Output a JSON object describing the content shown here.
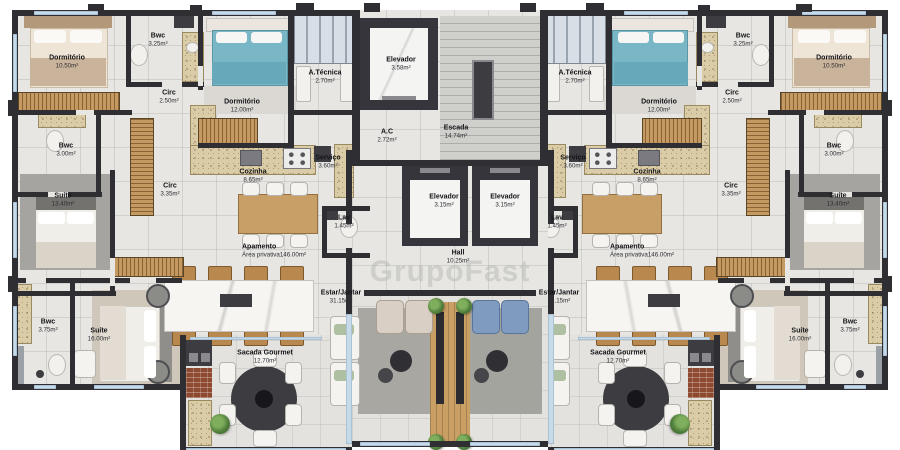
{
  "watermark": "GrupoFast",
  "colors": {
    "wall": "#2e2e33",
    "floor": "#e7e6e3",
    "wood": "#c8a067",
    "teal_bed": "#79b6c6",
    "blue_chair": "#7f9cc0",
    "beige_chair": "#d9cfc4",
    "brick": "#8d4a30",
    "window": "#c6dae9"
  },
  "rooms": [
    {
      "label": "Dormitório",
      "area": "10.50m²"
    },
    {
      "label": "Bwc",
      "area": "3.25m²"
    },
    {
      "label": "Circ",
      "area": "2.50m²"
    },
    {
      "label": "Dormitório",
      "area": "12.00m²"
    },
    {
      "label": "Bwc",
      "area": "3.00m²"
    },
    {
      "label": "Circ",
      "area": "3.35m²"
    },
    {
      "label": "Suíte",
      "area": "13.40m²"
    },
    {
      "label": "A.Técnica",
      "area": "2.70m²"
    },
    {
      "label": "Cozinha",
      "area": "8.65m²"
    },
    {
      "label": "Serviço",
      "area": "3.60m²"
    },
    {
      "label": "Lav",
      "area": "1.45m²"
    },
    {
      "label": "Apamento",
      "area": "Área privativa146.00m²"
    },
    {
      "label": "Bwc",
      "area": "3.75m²"
    },
    {
      "label": "Suíte",
      "area": "16.00m²"
    },
    {
      "label": "Estar/Jantar",
      "area": "31.15m²"
    },
    {
      "label": "Sacada Gourmet",
      "area": "12.70m²"
    },
    {
      "label": "Elevador",
      "area": "3.58m²"
    },
    {
      "label": "A.C",
      "area": "2.72m²"
    },
    {
      "label": "Escada",
      "area": "14.74m²"
    },
    {
      "label": "Elevador",
      "area": "3.15m²"
    },
    {
      "label": "Elevador",
      "area": "3.15m²"
    },
    {
      "label": "Hall",
      "area": "10.25m²"
    },
    {
      "label": "A.Técnica",
      "area": "2.70m²"
    },
    {
      "label": "Dormitório",
      "area": "12.00m²"
    },
    {
      "label": "Bwc",
      "area": "3.25m²"
    },
    {
      "label": "Dormitório",
      "area": "10.50m²"
    },
    {
      "label": "Circ",
      "area": "2.50m²"
    },
    {
      "label": "Serviço",
      "area": "3.60m²"
    },
    {
      "label": "Cozinha",
      "area": "8.65m²"
    },
    {
      "label": "Lav",
      "area": "1.45m²"
    },
    {
      "label": "Bwc",
      "area": "3.00m²"
    },
    {
      "label": "Circ",
      "area": "3.35m²"
    },
    {
      "label": "Suíte",
      "area": "13.40m²"
    },
    {
      "label": "Apamento",
      "area": "Área privativa146.00m²"
    },
    {
      "label": "Estar/Jantar",
      "area": "31.15m²"
    },
    {
      "label": "Sacada Gourmet",
      "area": "12.70m²"
    },
    {
      "label": "Suíte",
      "area": "16.00m²"
    },
    {
      "label": "Bwc",
      "area": "3.75m²"
    }
  ]
}
